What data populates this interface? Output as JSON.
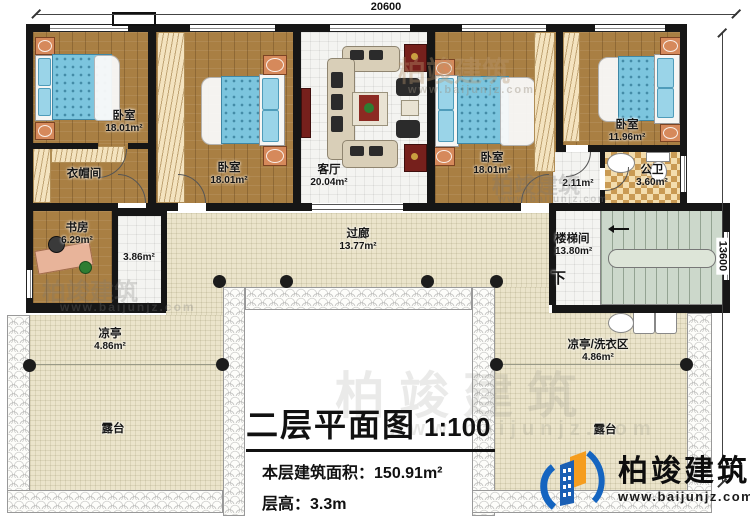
{
  "title": {
    "main": "二层平面图",
    "scale": "1:100",
    "area_label": "本层建筑面积：",
    "area_value": "150.91m²",
    "height_label": "层高：",
    "height_value": "3.3m"
  },
  "dims": {
    "top": "20600",
    "right": "13600"
  },
  "rooms": {
    "bedroom1": {
      "label": "卧室",
      "area": "18.01m²"
    },
    "cloakroom": {
      "label": "衣帽间"
    },
    "study": {
      "label": "书房",
      "area": "6.29m²"
    },
    "hall_small": {
      "area": "3.86m²"
    },
    "bedroom2": {
      "label": "卧室",
      "area": "18.01m²"
    },
    "living": {
      "label": "客厅",
      "area": "20.04m²"
    },
    "bedroom3": {
      "label": "卧室",
      "area": "18.01m²"
    },
    "bedroom4": {
      "label": "卧室",
      "area": "11.96m²"
    },
    "hall2": {
      "area": "2.11m²"
    },
    "bath": {
      "label": "公卫",
      "area": "3.60m²"
    },
    "stair": {
      "label": "楼梯间",
      "area": "13.80m²",
      "down": "下"
    },
    "corridor": {
      "label": "过廊",
      "area": "13.77m²"
    },
    "pavilion_left": {
      "label": "凉亭",
      "area": "4.86m²"
    },
    "terrace_left": {
      "label": "露台"
    },
    "pavilion_right": {
      "label": "凉亭/洗衣区",
      "area": "4.86m²"
    },
    "terrace_right": {
      "label": "露台"
    }
  },
  "branding": {
    "name": "柏竣建筑",
    "site": "www.baijunjz.com"
  },
  "colors": {
    "wall": "#161616",
    "wood": "#a97f43",
    "bed": "#7cc5de",
    "paving": "#ebe4cb",
    "stairs": "#ccd8cb",
    "brand_blue": "#1a5fb4",
    "brand_orange": "#f59d1e"
  }
}
